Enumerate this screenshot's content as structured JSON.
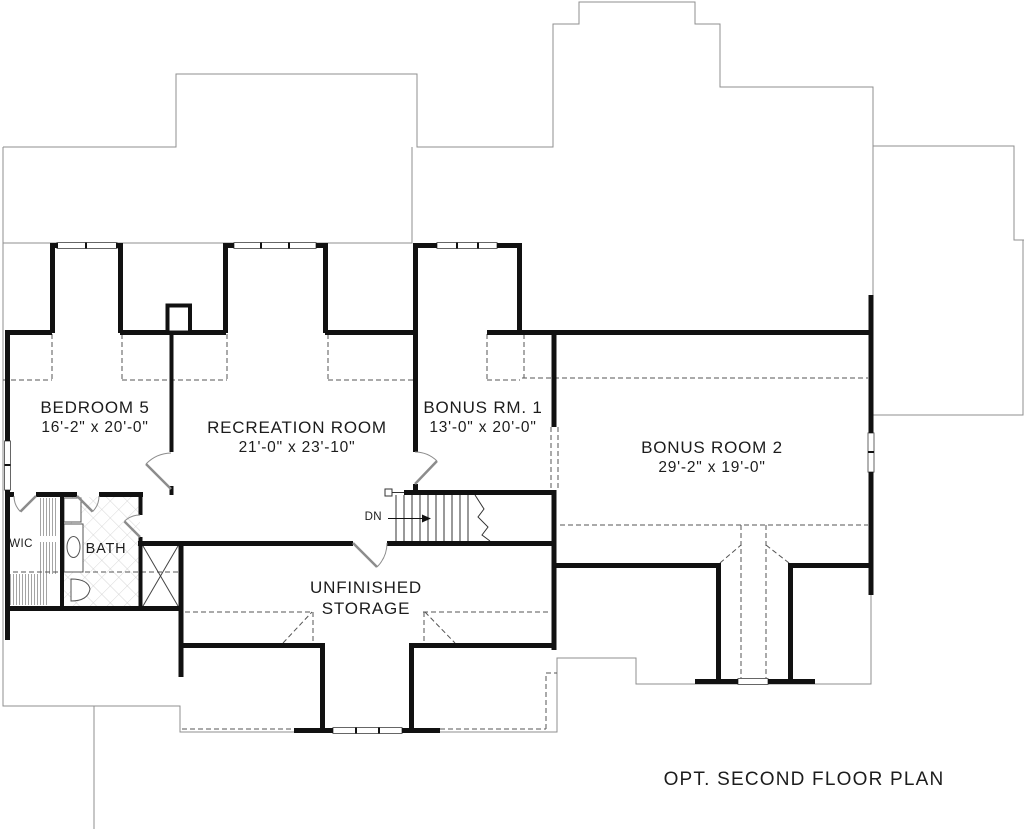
{
  "plan": {
    "title": "OPT. SECOND FLOOR PLAN",
    "rooms": [
      {
        "id": "bedroom5",
        "name": "BEDROOM 5",
        "dims": "16'-2\" x 20'-0\""
      },
      {
        "id": "recreation",
        "name": "RECREATION ROOM",
        "dims": "21'-0\" x 23'-10\""
      },
      {
        "id": "bonus1",
        "name": "BONUS RM. 1",
        "dims": "13'-0\" x 20'-0\""
      },
      {
        "id": "bonus2",
        "name": "BONUS ROOM 2",
        "dims": "29'-2\" x 19'-0\""
      },
      {
        "id": "storage",
        "name_line1": "UNFINISHED",
        "name_line2": "STORAGE"
      }
    ],
    "labels": {
      "wic": "WIC",
      "bath": "BATH",
      "stairs_direction": "DN"
    },
    "colors": {
      "wall": "#111111",
      "thin_line": "#8f8f8f",
      "dashed_line": "#555555",
      "door": "#8c8c8c",
      "background": "#ffffff"
    }
  }
}
